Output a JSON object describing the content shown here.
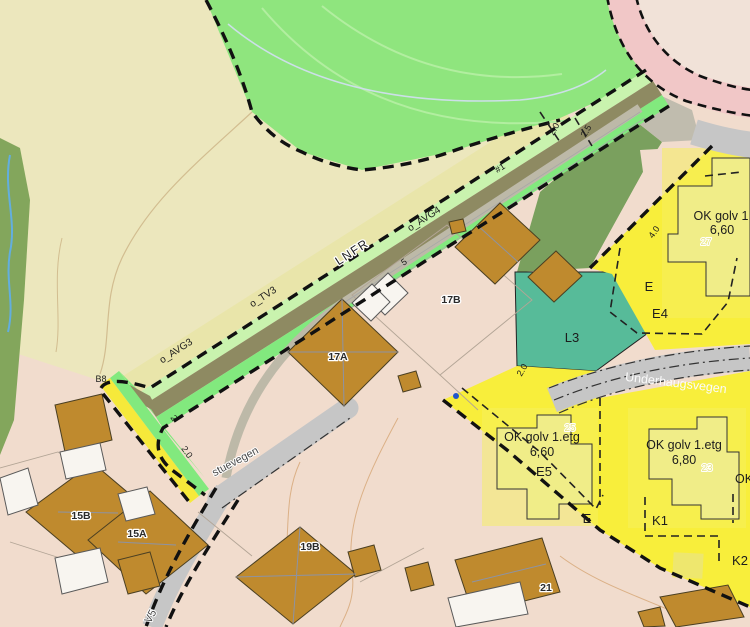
{
  "map": {
    "description": "Municipal zoning plan map over orthophoto-style basemap",
    "labels": {
      "lnfr": "LNFR",
      "avg4": "o_AVG4",
      "avg3": "o_AVG3",
      "tv3": "o_TV3",
      "hash1": "#1",
      "b8": "B8",
      "l3": "L3",
      "e_ne": "E",
      "e4": "E4",
      "e5": "E5",
      "e_mid": "E",
      "k1": "K1",
      "k2": "K2",
      "ok_edge": "OK",
      "ok_golv_1": "OK golv 1",
      "ok_golv_1_val": "6,60",
      "ok_golv_2": "OK golv 1.etg",
      "ok_golv_2_val": "6,60",
      "ok_golv_3": "OK golv 1.etg",
      "ok_golv_3_val": "6,80"
    },
    "measurements": {
      "w5": "5",
      "w2": "2",
      "w2_0_low": "2.0",
      "w2_0_top": "2.0",
      "w2_5_top": "2.5",
      "w4_0": "4.0",
      "w2_0_mid": "2.0"
    },
    "house_numbers": {
      "h17a": "17A",
      "h17b": "17B",
      "h15a": "15A",
      "h15b": "15B",
      "h19b": "19B",
      "h21": "21",
      "n27": "27",
      "n25": "25",
      "n23": "23"
    },
    "roads": {
      "underhaugsvegen": "Underhaugsvegen",
      "stuevegen": "stuevegen",
      "v5": "V5"
    },
    "palette": {
      "field_green": "#8fe57e",
      "beige_lnf": "#ece7bd",
      "lnf_band": "#e9e5aa",
      "dark_green": "#83a65c",
      "strip_pale_green": "#c9f3ae",
      "strip_olive": "#8e8a62",
      "strip_bright_green": "#82e97e",
      "strip_yellow": "#f6e93a",
      "zone_yellow": "#f8ee3b",
      "pale_building_yellow": "#f0ed88",
      "teal": "#57bb99",
      "olive_parcel": "#7aa05e",
      "residential_pink": "#f1dccd",
      "building_brown": "#bf8a2e",
      "road_grey": "#c6c6c6",
      "road_pink": "#f1c7c7",
      "boundary_black": "#111111",
      "stream_blue": "#63aede",
      "marker_blue": "#2255cc"
    }
  }
}
